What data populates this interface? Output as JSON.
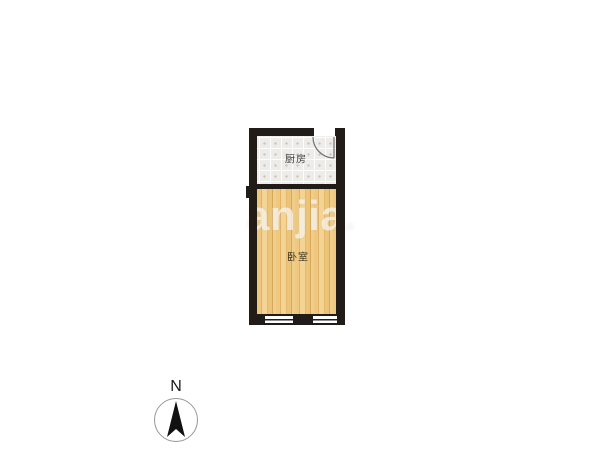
{
  "floorplan": {
    "watermark": "anjia.",
    "rooms": [
      {
        "name": "kitchen",
        "label": "厨房",
        "floor_type": "tile"
      },
      {
        "name": "bedroom",
        "label": "卧室",
        "floor_type": "wood"
      }
    ],
    "features": {
      "door": "swing-door-top-right-of-kitchen",
      "windows": "two-window-segments-bottom-wall-of-bedroom"
    },
    "compass": {
      "north_label": "N"
    },
    "colors": {
      "wall": "#211c17",
      "kitchen_floor": "#edece8",
      "kitchen_grid_dot": "#c9c5ba",
      "bedroom_floor_base": "#ecc57e",
      "bedroom_plank_line": "#d9a75b",
      "door_arc": "#6e6e6e",
      "compass_ring": "#979797",
      "compass_needle": "#111111",
      "watermark": "rgba(255,255,255,0.62)",
      "background": "#ffffff"
    }
  }
}
